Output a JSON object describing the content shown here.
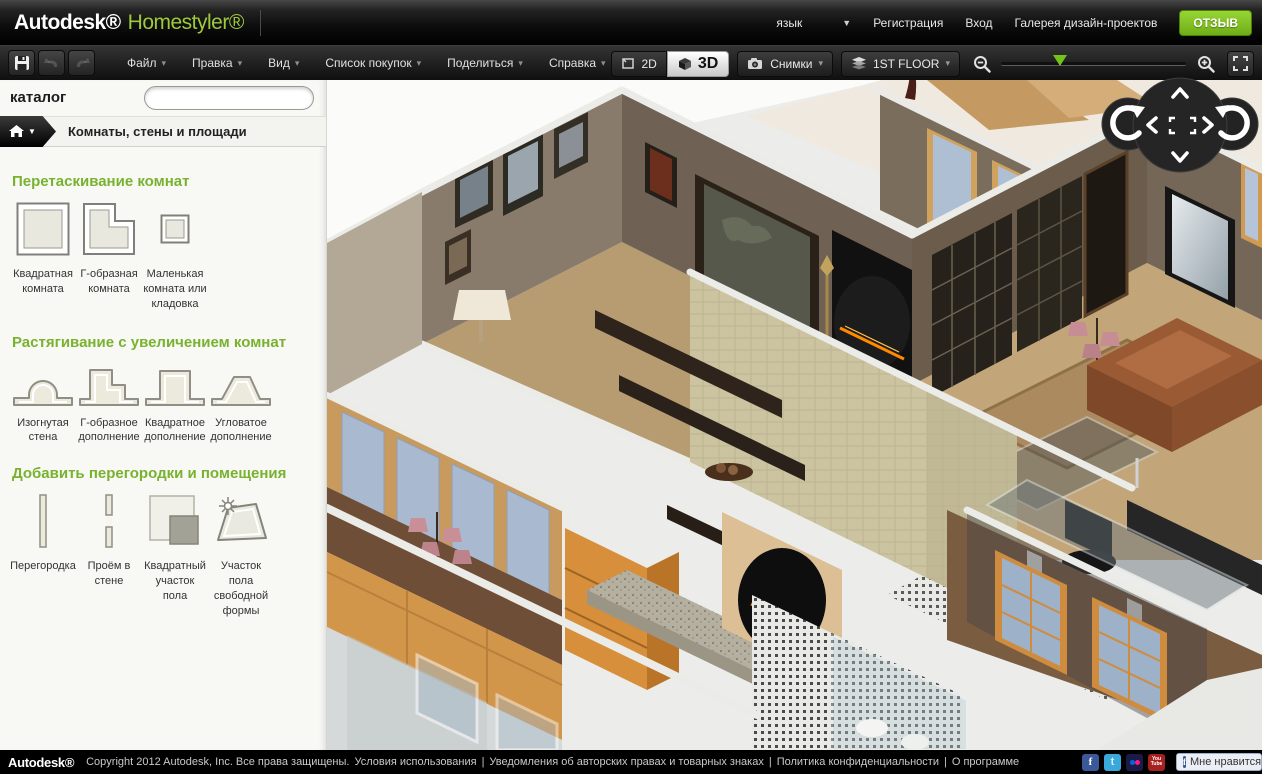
{
  "topbar": {
    "brand_autodesk": "Autodesk®",
    "brand_homestyler": "Homestyler®",
    "language": "язык",
    "register": "Регистрация",
    "login": "Вход",
    "gallery": "Галерея дизайн-проектов",
    "feedback": "ОТЗЫВ"
  },
  "toolbar": {
    "menus": [
      {
        "label": "Файл"
      },
      {
        "label": "Правка"
      },
      {
        "label": "Вид"
      },
      {
        "label": "Список покупок"
      },
      {
        "label": "Поделиться"
      },
      {
        "label": "Справка"
      }
    ],
    "view_2d": "2D",
    "view_3d": "3D",
    "active_view": "3D",
    "snapshots": "Снимки",
    "floor": "1ST FLOOR",
    "zoom_percent": 28
  },
  "icons": {
    "caret_down": "▾",
    "caret_down_solid": "▼"
  },
  "sidebar": {
    "title": "каталог",
    "search_value": "",
    "search_placeholder": "",
    "breadcrumb": "Комнаты, стены и площади",
    "sections": [
      {
        "heading": "Перетаскивание комнат",
        "items": [
          {
            "label": "Квадратная комната",
            "icon": "square-room-icon"
          },
          {
            "label": "Г-образная комната",
            "icon": "l-shaped-room-icon"
          },
          {
            "label": "Маленькая комната или кладовка",
            "icon": "small-room-icon"
          }
        ]
      },
      {
        "heading": "Растягивание с увеличением комнат",
        "items": [
          {
            "label": "Изогнутая стена",
            "icon": "curved-wall-icon"
          },
          {
            "label": "Г-образное дополнение",
            "icon": "l-addition-icon"
          },
          {
            "label": "Квадратное дополнение",
            "icon": "square-addition-icon"
          },
          {
            "label": "Угловатое дополнение",
            "icon": "angular-addition-icon"
          }
        ]
      },
      {
        "heading": "Добавить перегородки и помещения",
        "items": [
          {
            "label": "Перегородка",
            "icon": "partition-icon"
          },
          {
            "label": "Проём в стене",
            "icon": "wall-opening-icon"
          },
          {
            "label": "Квадратный участок пола",
            "icon": "square-floor-icon"
          },
          {
            "label": "Участок пола свободной формы",
            "icon": "freeform-floor-icon"
          }
        ]
      }
    ]
  },
  "footer": {
    "brand": "Autodesk®",
    "copyright": "Copyright 2012 Autodesk, Inc. Все права защищены.",
    "separator": "|",
    "links": [
      {
        "label": "Условия использования"
      },
      {
        "label": "Уведомления об авторских правах и товарных знаках"
      },
      {
        "label": "Политика конфиденциальности"
      },
      {
        "label": "О программе"
      }
    ],
    "social_f": "f",
    "social_t": "t",
    "youtube_line1": "You",
    "youtube_line2": "Tube",
    "like": "Мне нравится"
  },
  "colors": {
    "accent_green": "#78b22e",
    "brand_green": "#9dc93b",
    "feedback_green": "#7ec22b",
    "wall_taupe": "#6f6254",
    "wall_brown": "#6b5c4c",
    "cabinet_orange": "#d2964b",
    "fire_orange": "#ff8a00"
  }
}
